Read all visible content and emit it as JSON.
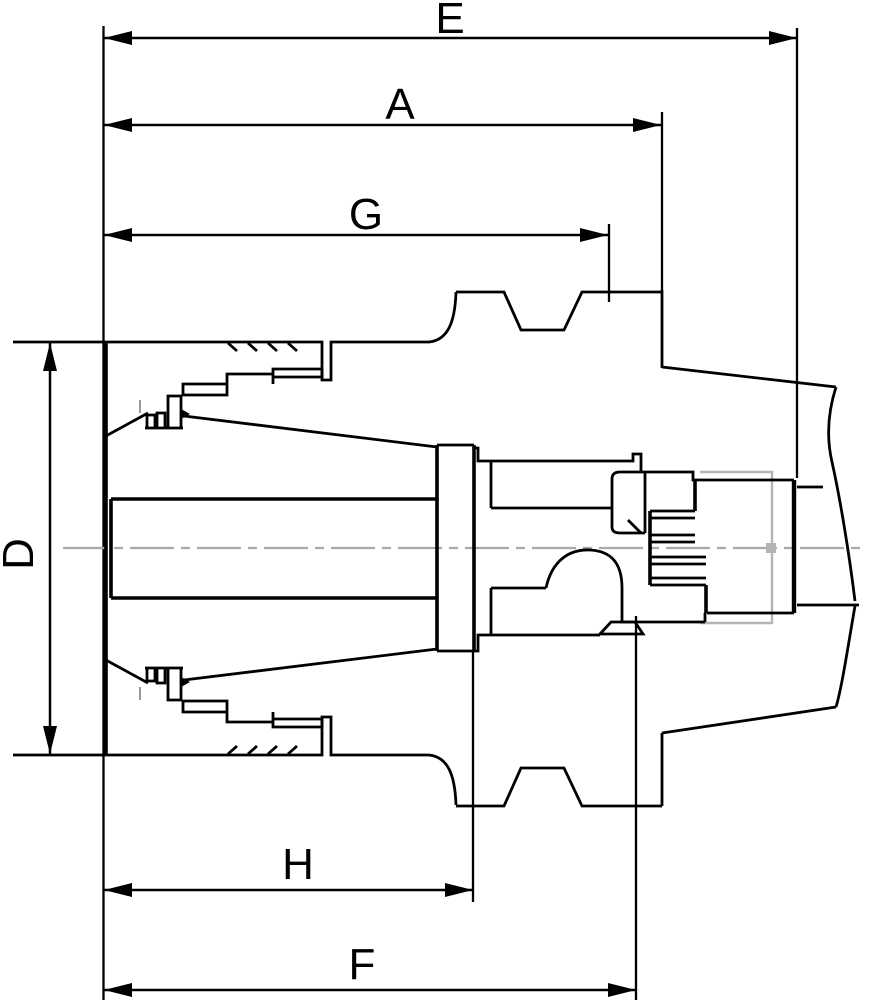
{
  "drawing": {
    "kind": "technical-drawing",
    "subject": "Collet chuck tool holder with pull stud seated in machine spindle, sectional view with dimension callouts",
    "background": "#ffffff",
    "colors": {
      "outline": "#000000",
      "centerline": "#a9a9a9",
      "hidden_line": "#b5b5b5"
    },
    "dimension_labels": {
      "e": "E",
      "a": "A",
      "g": "G",
      "d": "D",
      "h": "H",
      "f": "F"
    }
  }
}
